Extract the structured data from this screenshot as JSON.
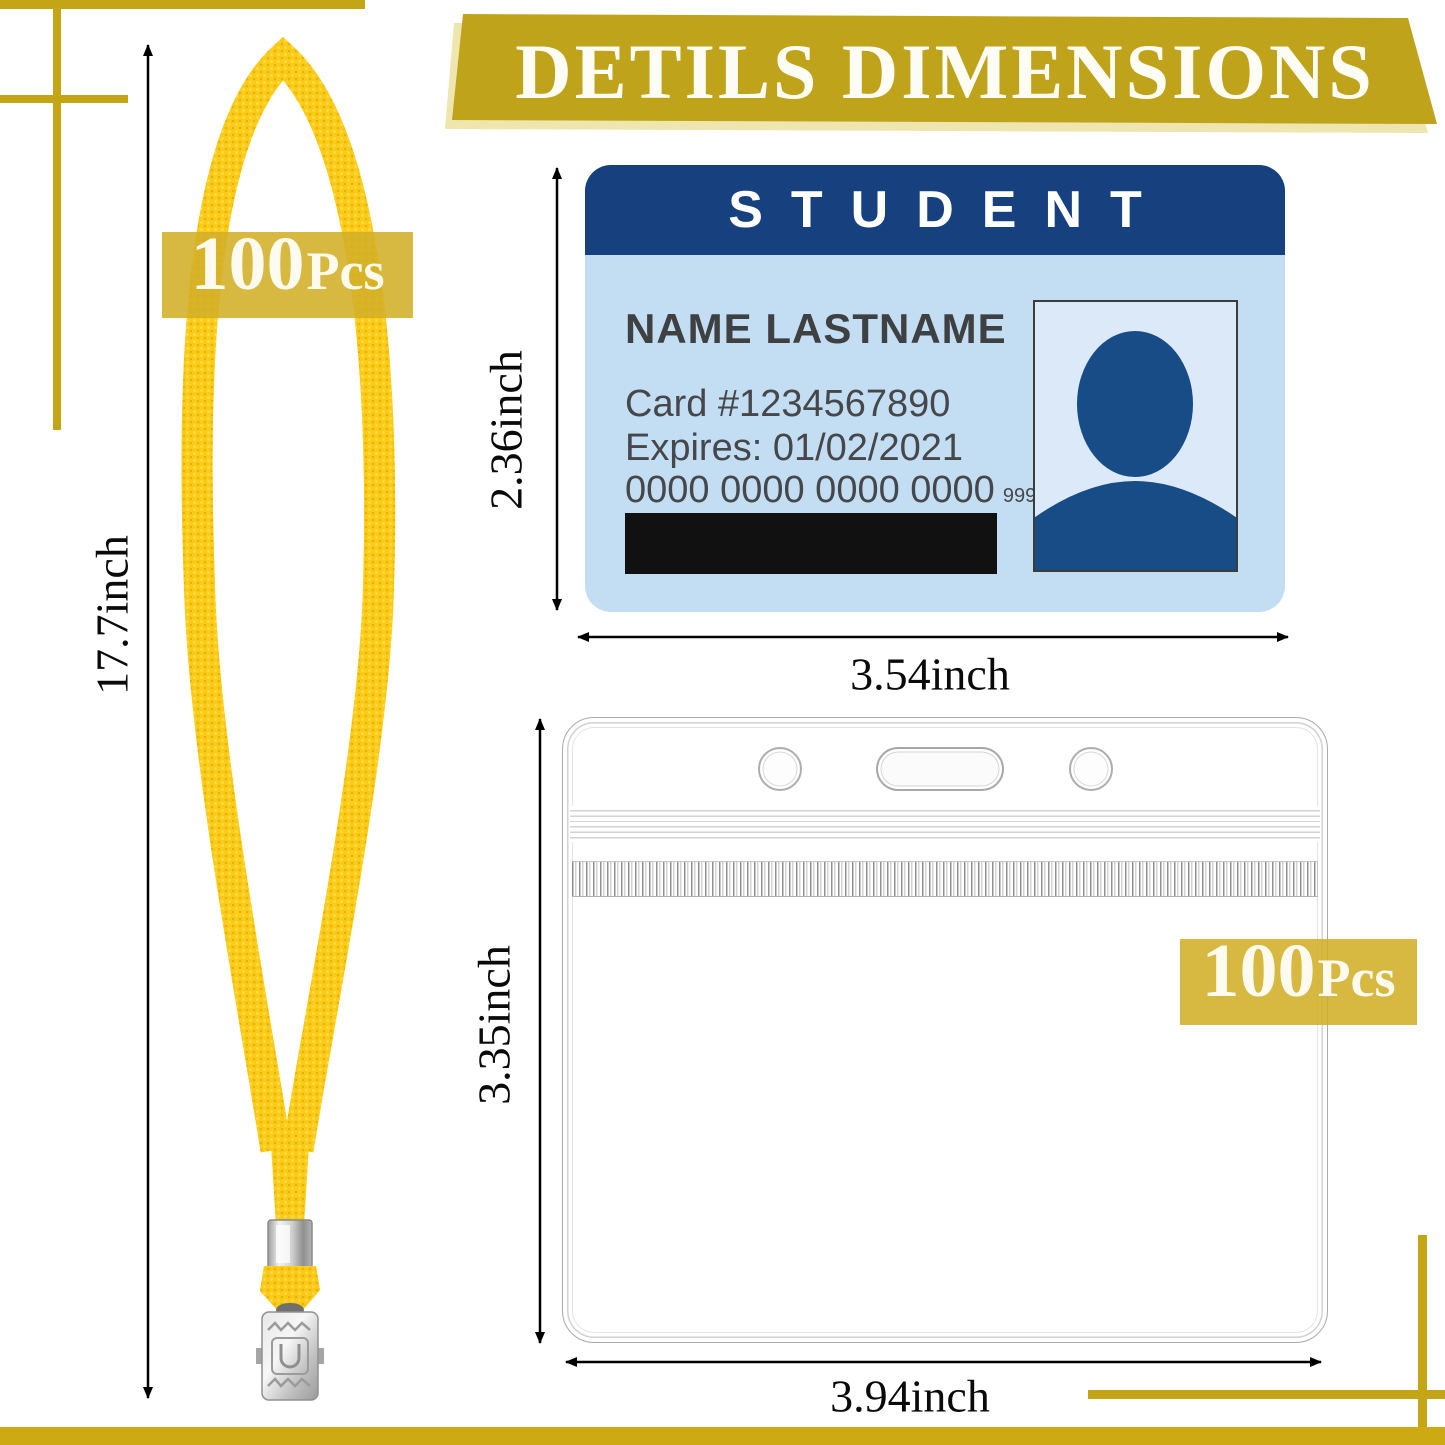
{
  "banner": {
    "title": "DETILS DIMENSIONS"
  },
  "lanyard": {
    "badge": {
      "count": "100",
      "unit": "Pcs"
    },
    "length_label": "17.7inch"
  },
  "card": {
    "header": "STUDENT",
    "name": "NAME LASTNAME",
    "card_number": "Card #1234567890",
    "expires": "Expires: 01/02/2021",
    "account_number": "0000 0000 0000 0000",
    "cvv": "999",
    "height_label": "2.36inch",
    "width_label": "3.54inch"
  },
  "holder": {
    "badge": {
      "count": "100",
      "unit": "Pcs"
    },
    "height_label": "3.35inch",
    "width_label": "3.94inch"
  },
  "colors": {
    "accent_gold": "#C4A515",
    "banner_gold": "#BFA31A",
    "banner_shadow": "#EFE5AE",
    "badge_gold": "#D2AF28",
    "lanyard_yellow": "#FBCC17",
    "card_header_blue": "#16407E",
    "card_body_blue": "#C3DEF3",
    "photo_bg_blue": "#DCE9F8",
    "avatar_blue": "#174C87",
    "stripe_black": "#111111"
  }
}
